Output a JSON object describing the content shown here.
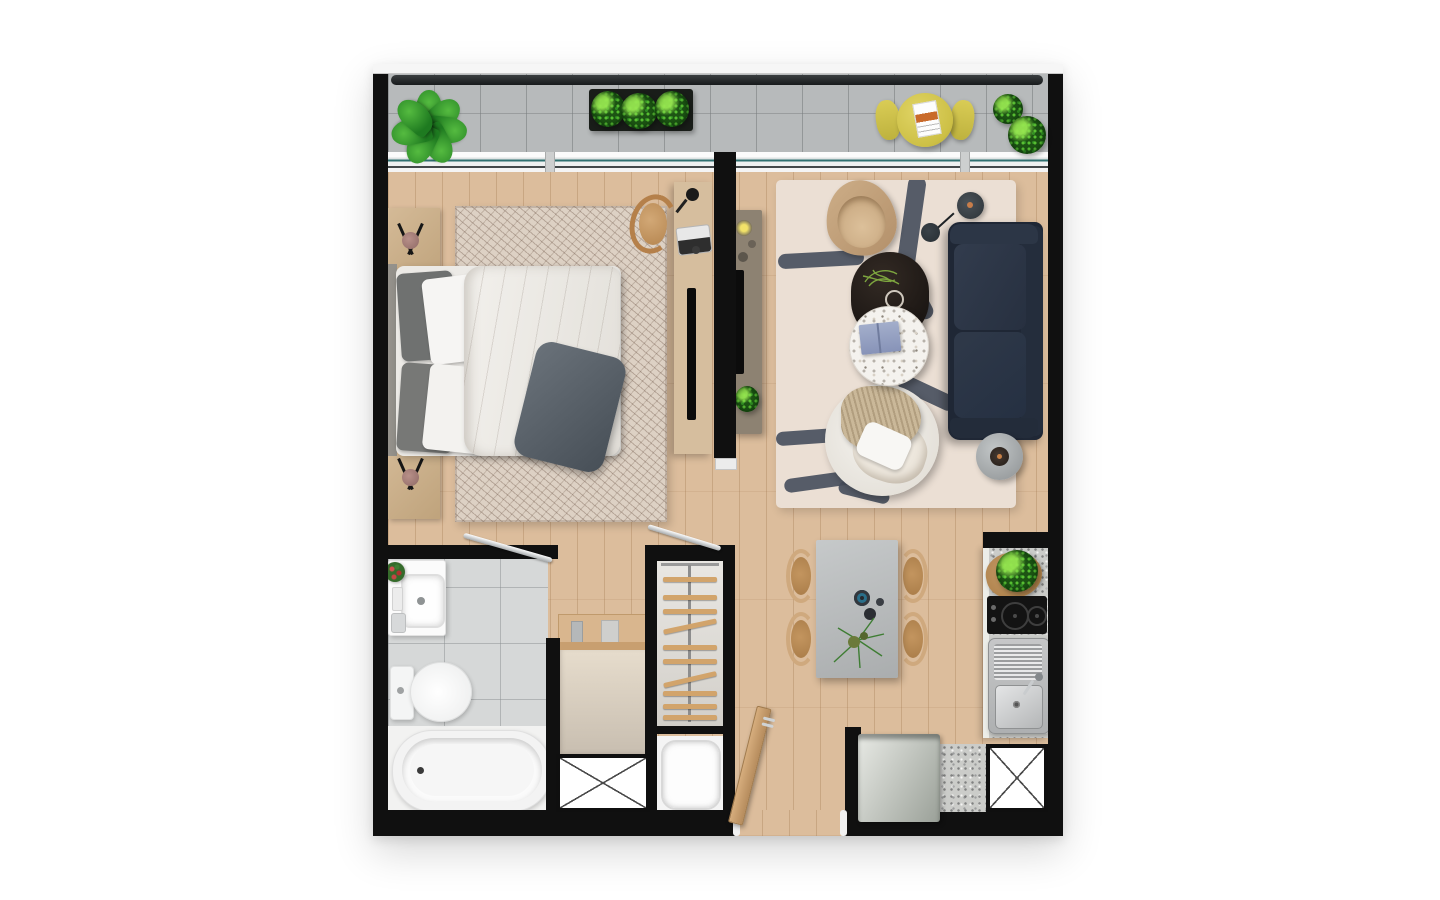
{
  "scene": {
    "type": "architectural-floor-plan",
    "view": "top-down-render",
    "background": "#ffffff",
    "visible_text": []
  },
  "colors": {
    "wall": "#101010",
    "wood-floor": "#dcbd9c",
    "balcony-tile": "#b7babb",
    "bath-tile": "#d6d8d8",
    "granite": "#cbccc9",
    "bedroom-rug": "#ddd1c4",
    "living-rug": "#ebdfd4",
    "rug-stroke": "#49505e",
    "sofa-navy": "#273040",
    "accent-yellow": "#d2c54c",
    "plant-green": "#2e8f25",
    "window-glass-teal": "#2f7070",
    "furniture-wood": "#d6be9e"
  },
  "rooms": [
    {
      "id": "balcony",
      "items": [
        "monstera-plant",
        "planter-box",
        "round-yellow-table",
        "yellow-chair",
        "yellow-chair",
        "potted-bush",
        "potted-bush",
        "glass-railing"
      ]
    },
    {
      "id": "bedroom",
      "items": [
        "double-bed",
        "nightstand",
        "nightstand",
        "patterned-rug",
        "desk",
        "desk-chair",
        "laptop",
        "desk-lamp",
        "tv-panel"
      ]
    },
    {
      "id": "living-room",
      "items": [
        "navy-sofa",
        "media-console",
        "tv",
        "lounge-chair",
        "floor-lamp",
        "oval-coffee-table",
        "terrazzo-side-table",
        "armchair",
        "round-side-table",
        "abstract-rug"
      ]
    },
    {
      "id": "dining-area",
      "items": [
        "stone-table",
        "dining-chair",
        "dining-chair",
        "dining-chair",
        "dining-chair",
        "centerpiece-plant"
      ]
    },
    {
      "id": "kitchen",
      "items": [
        "granite-counter",
        "cooktop",
        "sink",
        "fridge",
        "shaft-duct"
      ]
    },
    {
      "id": "bathroom",
      "items": [
        "vanity-sink",
        "toilet",
        "bathtub",
        "flowers",
        "swing-door"
      ]
    },
    {
      "id": "hall",
      "items": [
        "shelf",
        "cabinet",
        "shaft-duct"
      ]
    },
    {
      "id": "closet",
      "items": [
        "hanging-rod",
        "hangers",
        "swing-door"
      ]
    },
    {
      "id": "laundry",
      "items": [
        "washing-machine"
      ]
    },
    {
      "id": "entry",
      "items": [
        "entry-door"
      ]
    }
  ],
  "closet": {
    "hangers": [
      {
        "y": 16,
        "rot": 0
      },
      {
        "y": 34,
        "rot": 0
      },
      {
        "y": 48,
        "rot": 0
      },
      {
        "y": 63,
        "rot": -12
      },
      {
        "y": 84,
        "rot": 0
      },
      {
        "y": 98,
        "rot": 0
      },
      {
        "y": 116,
        "rot": -13
      },
      {
        "y": 130,
        "rot": 0
      },
      {
        "y": 143,
        "rot": 0
      },
      {
        "y": 154,
        "rot": 0
      }
    ]
  },
  "living_room": {
    "rug_strokes": [
      {
        "x": 126,
        "y": -4,
        "w": 18,
        "h": 102,
        "rot": 8
      },
      {
        "x": 2,
        "y": 72,
        "w": 86,
        "h": 15,
        "rot": -3
      },
      {
        "x": 130,
        "y": 78,
        "w": 16,
        "h": 64,
        "rot": -28
      },
      {
        "x": 120,
        "y": 205,
        "w": 62,
        "h": 16,
        "rot": 25
      },
      {
        "x": 0,
        "y": 250,
        "w": 64,
        "h": 14,
        "rot": -4
      },
      {
        "x": 8,
        "y": 294,
        "w": 80,
        "h": 14,
        "rot": -8
      },
      {
        "x": 62,
        "y": 306,
        "w": 52,
        "h": 13,
        "rot": 14
      }
    ]
  }
}
